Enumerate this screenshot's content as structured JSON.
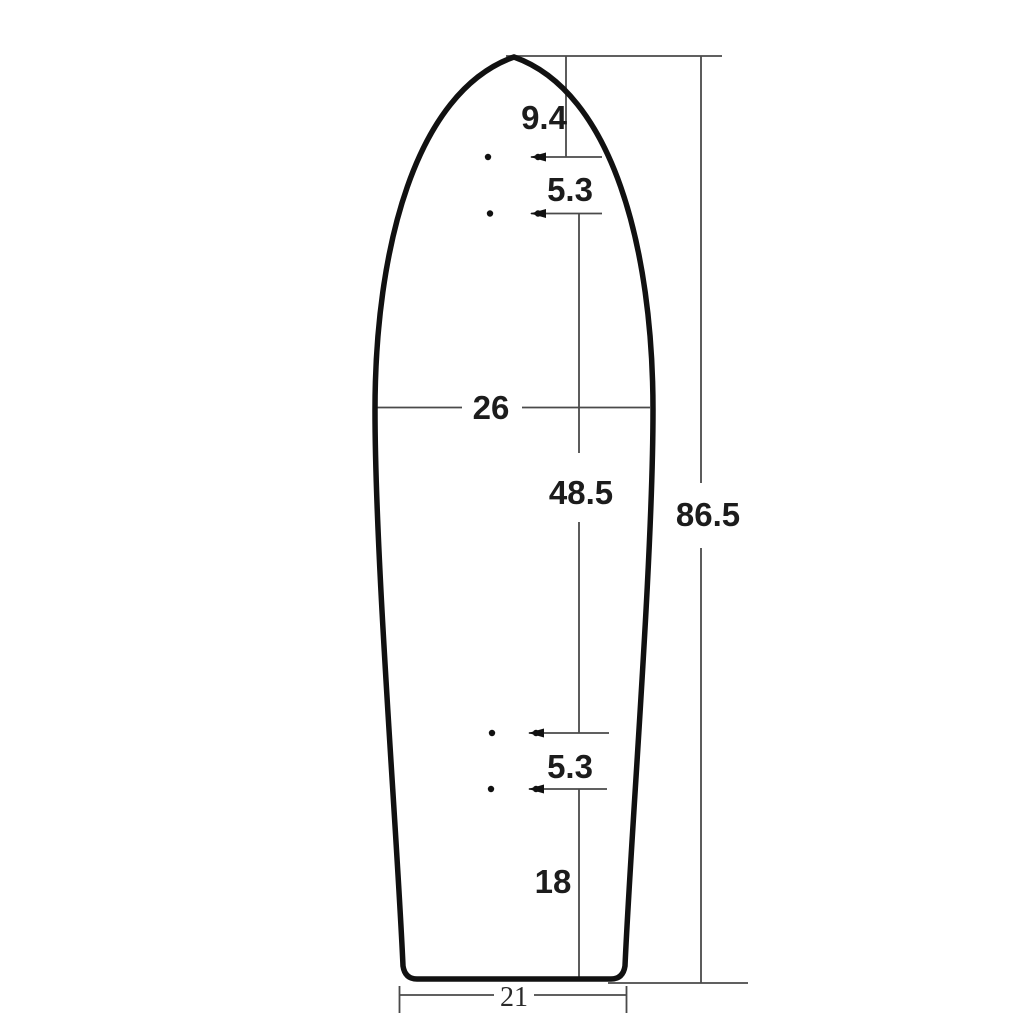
{
  "diagram": {
    "type": "dimension-drawing",
    "subject": "skateboard-deck-outline-top-view",
    "labels": {
      "nose_to_front_holes": "9.4",
      "front_hole_spacing": "5.3",
      "max_width": "26",
      "hole_to_hole_length": "48.5",
      "overall_length": "86.5",
      "rear_hole_spacing": "5.3",
      "rear_holes_to_tail": "18",
      "tail_width": "21"
    },
    "colors": {
      "outline": "#111111",
      "dimension_lines": "#4a4a4a",
      "text": "#1c1c1c",
      "background": "#ffffff"
    }
  }
}
